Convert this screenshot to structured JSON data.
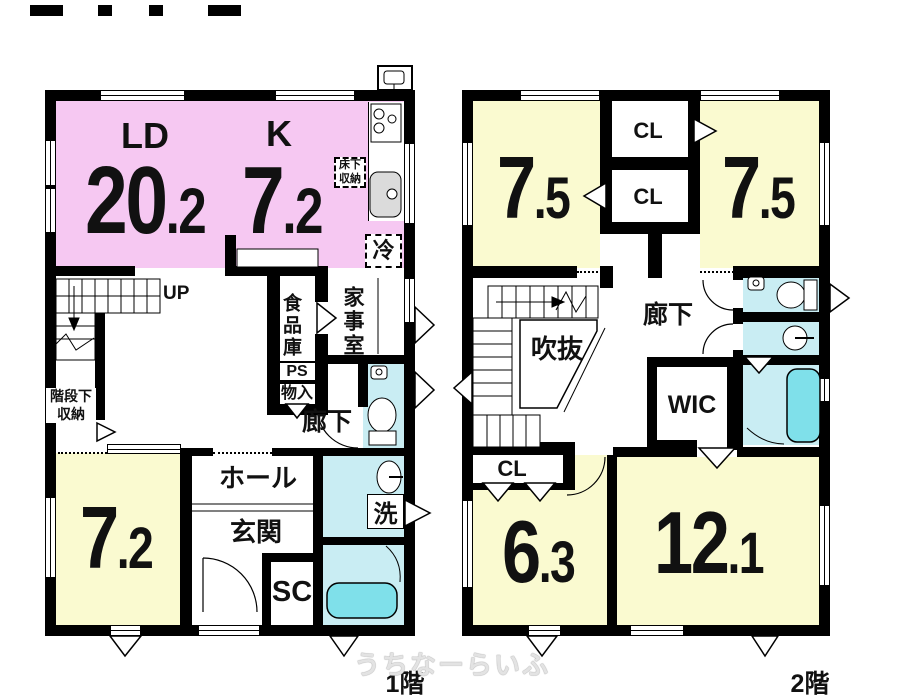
{
  "watermark": "うちなーらいふ",
  "colors": {
    "wall": "#000000",
    "ldk_pink": "#F6C8F2",
    "room_yellow": "#FAFAD0",
    "wet_area_cyan": "#C9EDF3",
    "bathtub_cyan": "#7FE0EA"
  },
  "floor1": {
    "label": "1階",
    "ld_label": "LD",
    "ld_main": "20",
    "ld_dec": ".2",
    "k_label": "K",
    "k_main": "7",
    "k_dec": ".2",
    "west_room_main": "7",
    "west_room_dec": ".2",
    "up_label": "UP",
    "underfloor_label": "床下収納",
    "fridge_label": "冷",
    "pantry_label": "食品庫",
    "utility_label": "家事室",
    "ps_label": "PS",
    "storage_label": "物入",
    "corridor_label": "廊下",
    "understairs_label": "階段下収納",
    "hall_label": "ホール",
    "entrance_label": "玄関",
    "shoe_closet_label": "SC",
    "laundry_label": "洗"
  },
  "floor2": {
    "label": "2階",
    "nw_main": "7",
    "nw_dec": ".5",
    "ne_main": "7",
    "ne_dec": ".5",
    "cl1_label": "CL",
    "cl2_label": "CL",
    "cl3_label": "CL",
    "void_label": "吹抜",
    "corridor_label": "廊下",
    "wic_label": "WIC",
    "sw_main": "6",
    "sw_dec": ".3",
    "se_main": "12",
    "se_dec": ".1"
  }
}
